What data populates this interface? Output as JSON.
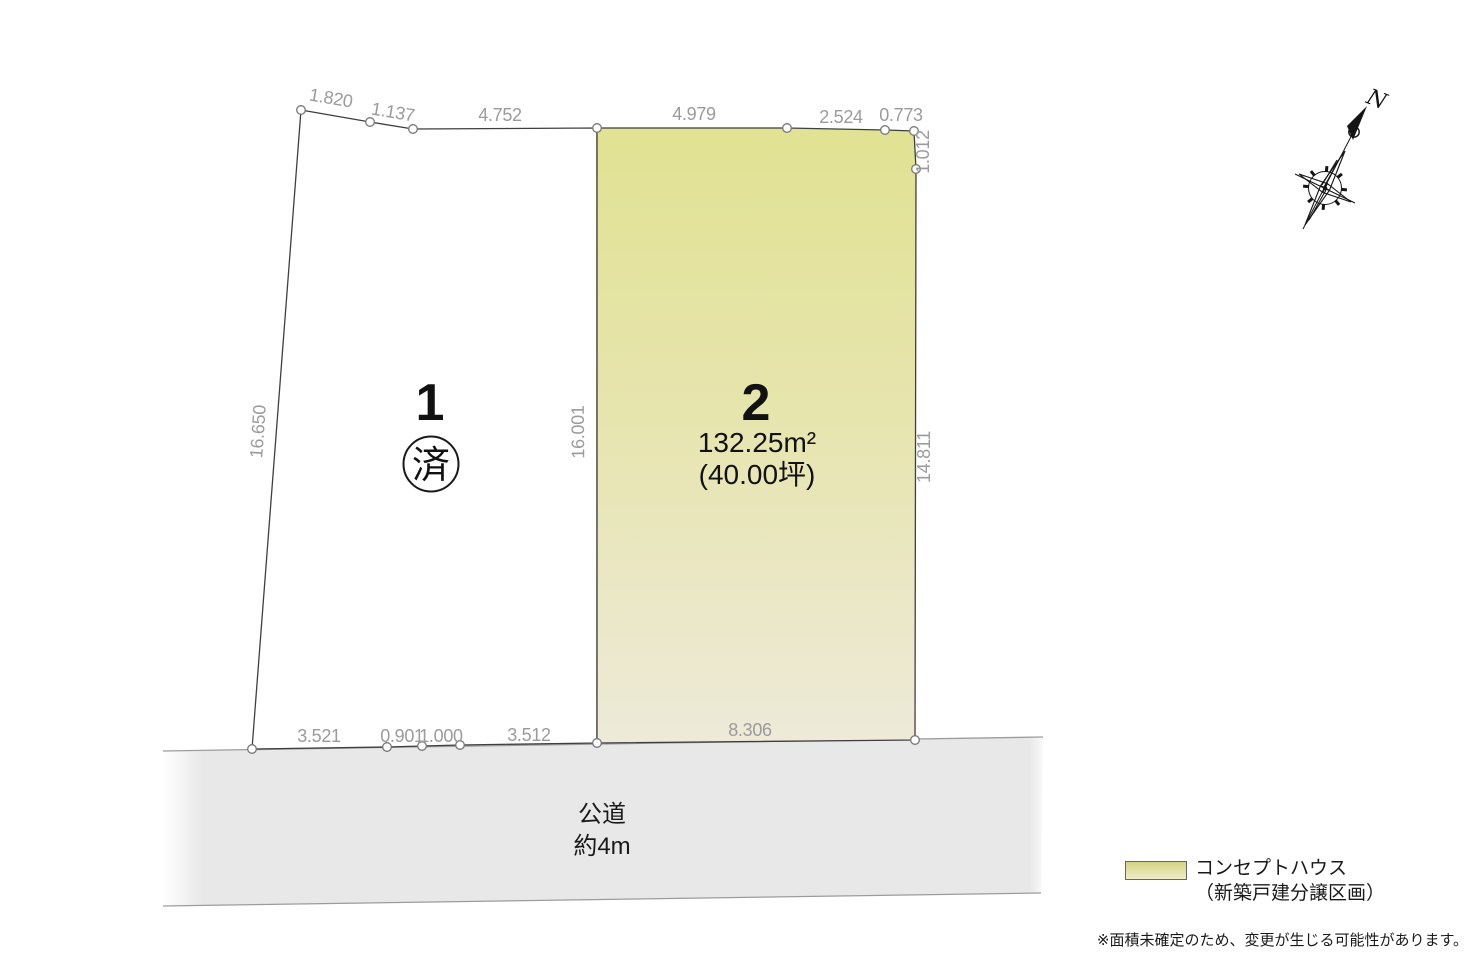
{
  "diagram_title_hidden": "",
  "lots": {
    "lot1": {
      "number": "1",
      "status_badge": "済"
    },
    "lot2": {
      "number": "2",
      "area_m2": "132.25m²",
      "area_tsubo": "(40.00坪)"
    }
  },
  "dimensions": {
    "top": [
      "1.820",
      "1.137",
      "4.752",
      "4.979",
      "2.524",
      "0.773"
    ],
    "left": "16.650",
    "center_boundary": "16.001",
    "right": [
      "1.012",
      "14.811"
    ],
    "bottom": [
      "3.521",
      "0.901",
      "1.000",
      "3.512",
      "8.306"
    ]
  },
  "road": {
    "name": "公道",
    "width_label": "約4m"
  },
  "compass": {
    "north_label": "N"
  },
  "legend": {
    "title": "コンセプトハウス",
    "subtitle": "（新築戸建分譲区画）"
  },
  "footnote": "※面積未確定のため、変更が生じる可能性があります。",
  "colors": {
    "lot1_fill": "#ffffff",
    "lot2_fill_top": "#e1e293",
    "lot2_fill_mid": "#e7e5b0",
    "lot2_fill_bottom": "#edead9",
    "road_fill": "#e8e8e8",
    "outline": "#3f3f3f",
    "dim_text": "#9b9b9b",
    "legend_swatch_top": "#d3d385",
    "legend_swatch_bottom": "#efeccb"
  }
}
